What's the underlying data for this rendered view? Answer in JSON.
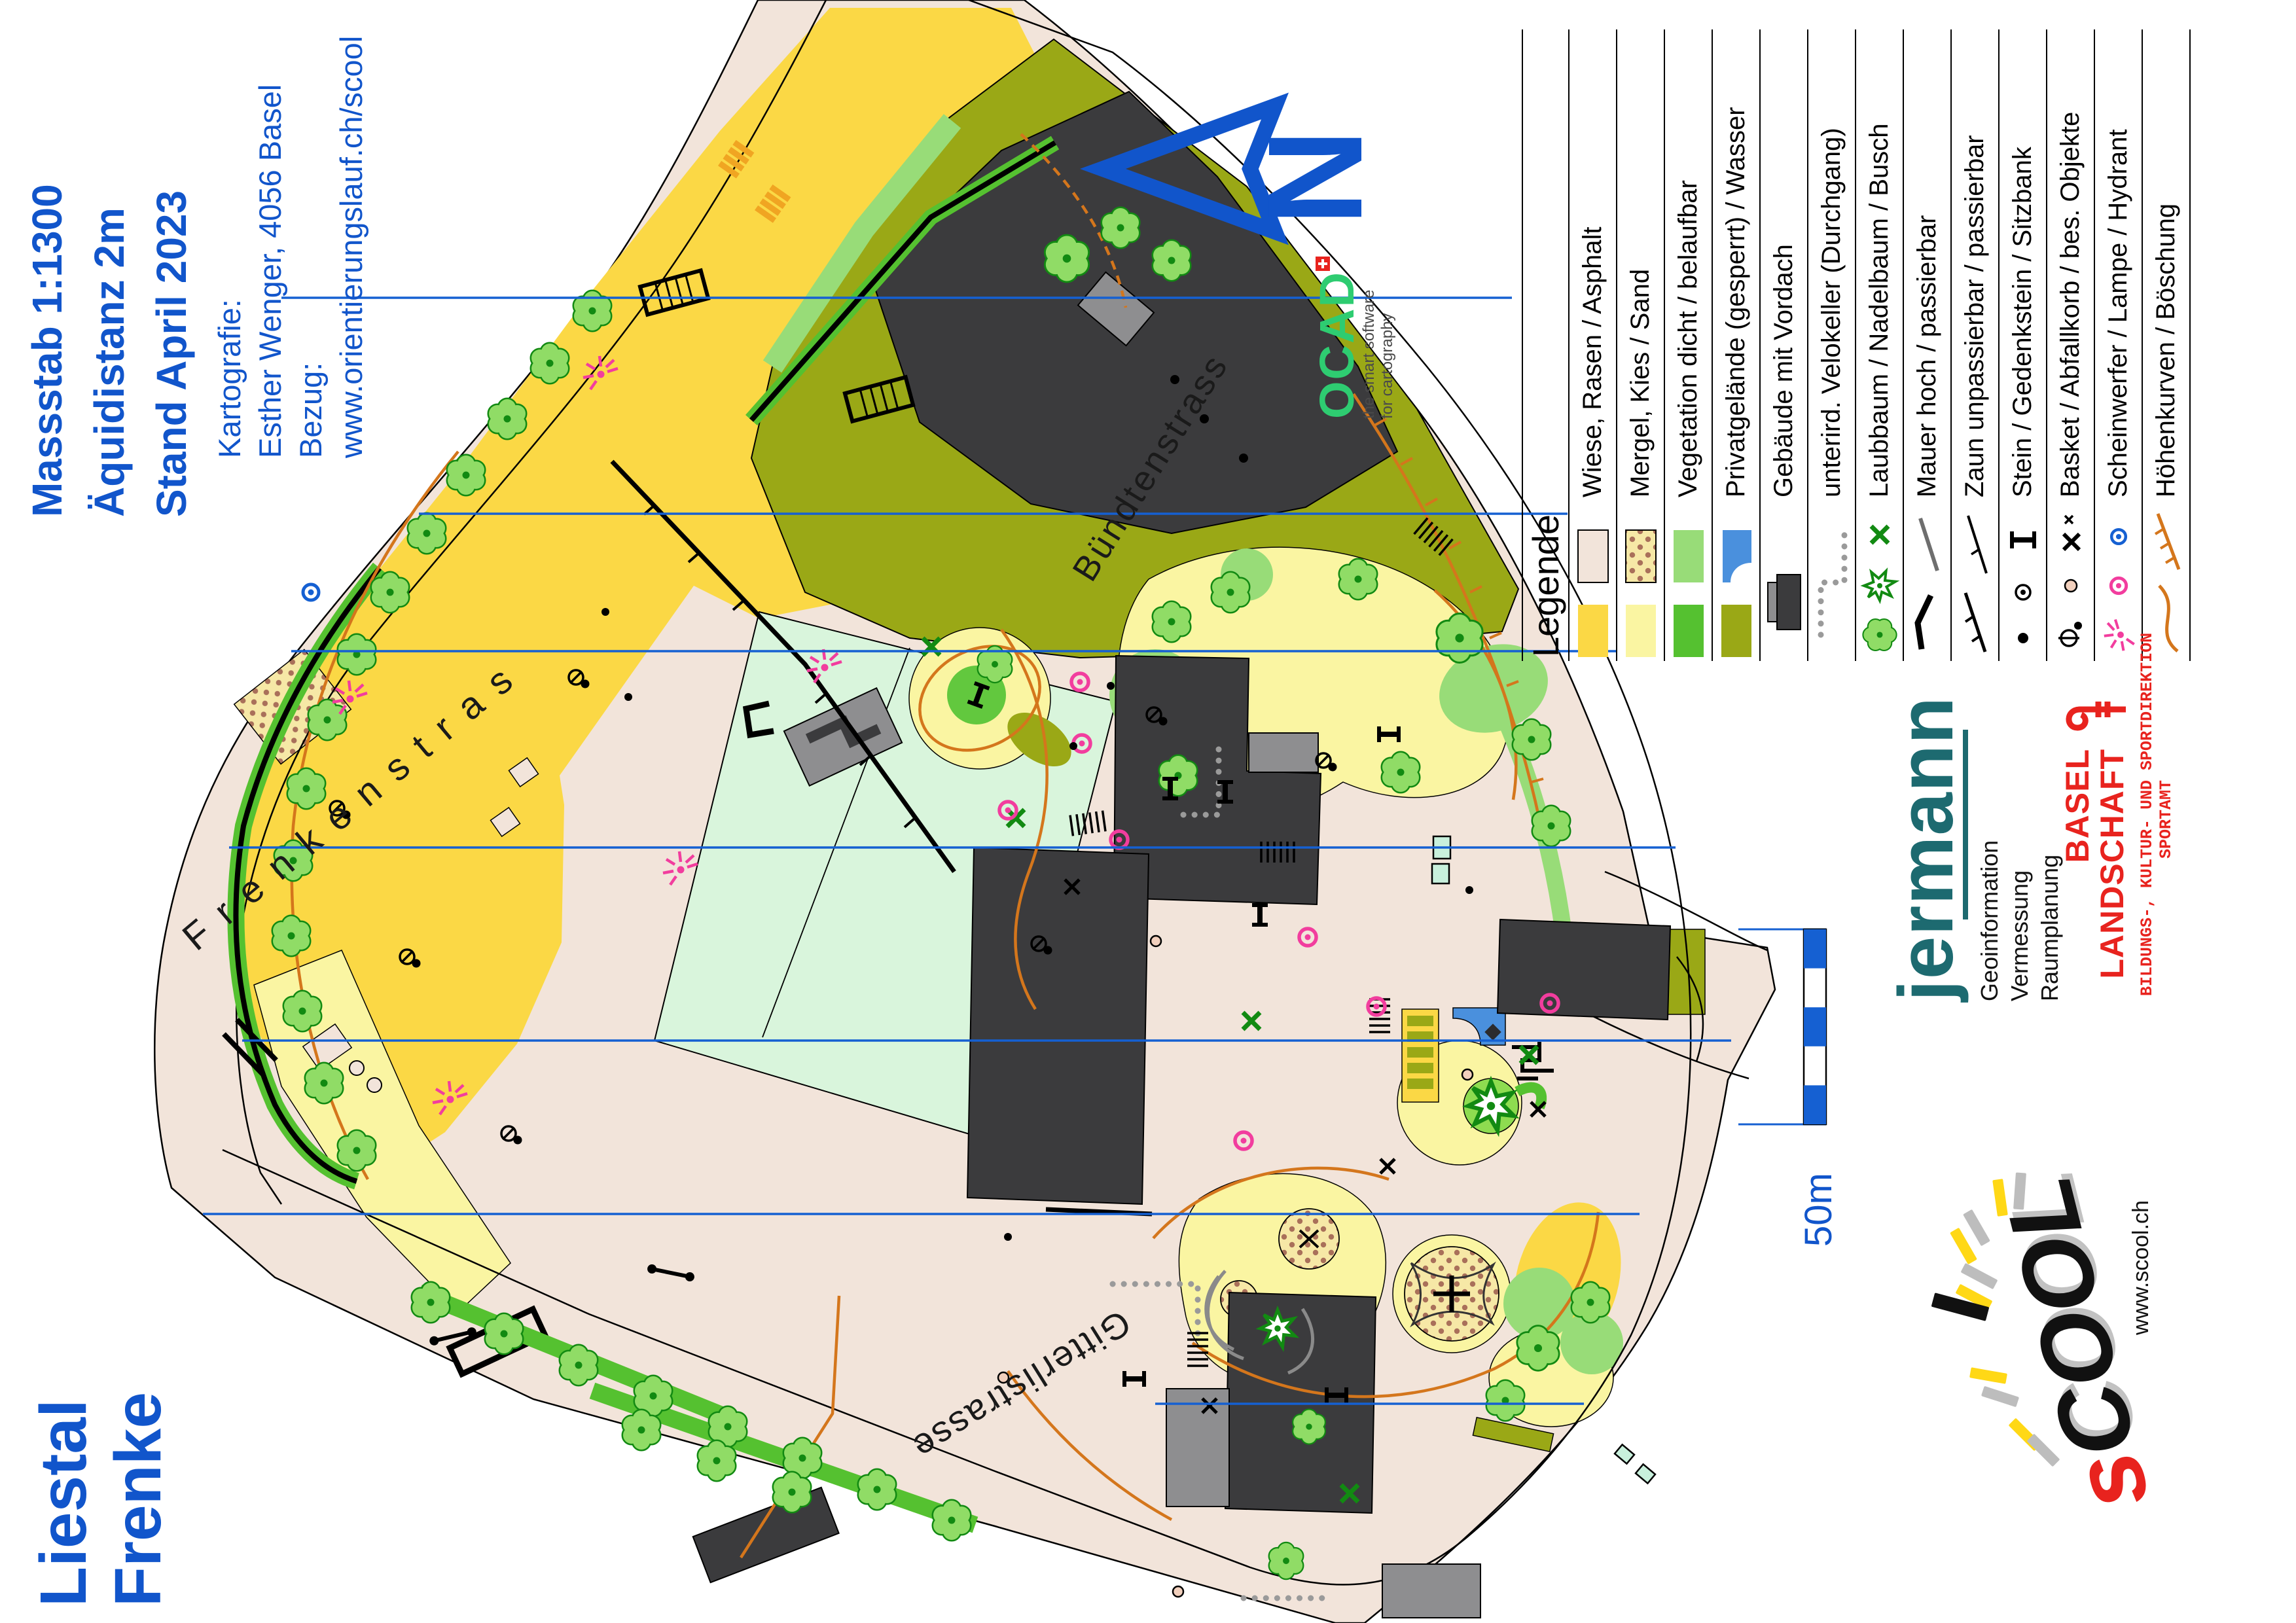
{
  "header": {
    "title_lines": [
      "Massstab 1:1300",
      "Äquidistanz 2m",
      "Stand April 2023"
    ],
    "credit_lines": [
      "Kartografie:",
      "Esther Wenger, 4056 Basel",
      "Bezug:",
      "www.orientierungslauf.ch/scool"
    ]
  },
  "map_title": {
    "line1": "Liestal",
    "line2": "Frenke"
  },
  "north_arrow": {
    "label": "N"
  },
  "scale": {
    "label": "50m"
  },
  "streets": [
    {
      "name": "Bündtenstrass"
    },
    {
      "name": "Frenkenstras"
    },
    {
      "name": "Gitterlistrasse"
    }
  ],
  "legend": {
    "heading": "Legende",
    "items": [
      {
        "label": "Wiese, Rasen / Asphalt"
      },
      {
        "label": "Mergel, Kies / Sand"
      },
      {
        "label": "Vegetation dicht / belaufbar"
      },
      {
        "label": "Privatgelände (gesperrt) / Wasser"
      },
      {
        "label": "Gebäude mit Vordach"
      },
      {
        "label": "unterird. Velokeller (Durchgang)"
      },
      {
        "label": "Laubbaum / Nadelbaum / Busch"
      },
      {
        "label": "Mauer hoch / passierbar"
      },
      {
        "label": "Zaun unpassierbar / passierbar"
      },
      {
        "label": "Stein / Gedenkstein / Sitzbank"
      },
      {
        "label": "Basket / Abfallkorb / bes. Objekte"
      },
      {
        "label": "Scheinwerfer / Lampe / Hydrant"
      },
      {
        "label": "Höhenkurven / Böschung"
      }
    ]
  },
  "logos": {
    "ocad": {
      "name": "OCAD",
      "tagline1": "the smart software",
      "tagline2": "for cartography"
    },
    "jermann": {
      "name": "jermann",
      "services": [
        "Geoinformation",
        "Vermessung",
        "Raumplanung"
      ]
    },
    "basel": {
      "line1": "BASEL",
      "line2": "LANDSCHAFT",
      "dept": "BILDUNGS-, KULTUR- UND SPORTDIREKTION",
      "office": "SPORTAMT"
    },
    "scool": {
      "wordmark_s": "s",
      "wordmark_rest": "COOL",
      "url": "www.scool.ch"
    }
  },
  "colors": {
    "credit_blue": "#1155cb",
    "north_line_blue": "#1560d2",
    "open_beige": "#f2e4da",
    "grass_yellow": "#fbd845",
    "rough_pale_yellow": "#faf5a2",
    "veg_light_green": "#98dc78",
    "veg_green": "#55c130",
    "private_olive": "#9aa816",
    "water_blue": "#4a90dd",
    "building_dark": "#3b3b3d",
    "canopy_gray": "#8e8e90",
    "contour_orange": "#d4761c",
    "lamp_pink": "#f23d9e",
    "ocad_green": "#2ecc71",
    "jermann_teal": "#1d6a70",
    "basel_red": "#e8231e",
    "scool_yellow": "#ffd816"
  }
}
